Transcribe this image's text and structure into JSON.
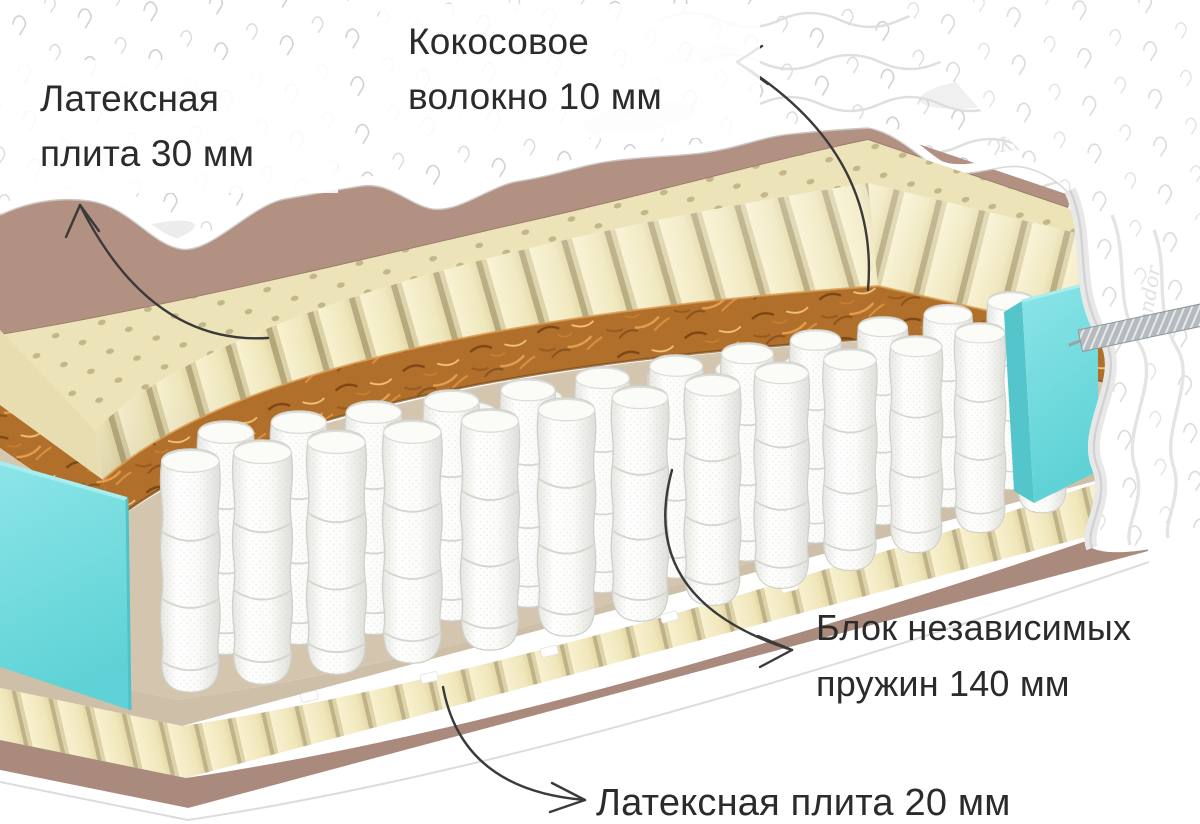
{
  "title": "Схема слоёв матраса в разрезе",
  "annotations": {
    "latex_top": {
      "line1": "Латексная",
      "line2": "плита 30 мм"
    },
    "coconut": {
      "line1": "Кокосовое",
      "line2": "волокно 10 мм"
    },
    "spring_block": {
      "line1": "Блок независимых",
      "line2": "пружин 140 мм"
    },
    "latex_bottom": {
      "line1": "Латексная плита 20 мм"
    }
  },
  "cover": {
    "watermark": "Kondor"
  },
  "layers": [
    {
      "name": "quilted-cover",
      "color": "#ffffff"
    },
    {
      "name": "felt-underlay",
      "color": "#b29183"
    },
    {
      "name": "latex-plate-30mm",
      "color": "#f2eac2"
    },
    {
      "name": "coconut-fiber-10mm",
      "color": "#b06f2a"
    },
    {
      "name": "spring-deck-felt",
      "color": "#d3c5ae"
    },
    {
      "name": "independent-spring-block-140mm",
      "color": "#f7f7f4"
    },
    {
      "name": "latex-plate-20mm",
      "color": "#f1e9c2"
    },
    {
      "name": "bottom-felt",
      "color": "#a98a7c"
    },
    {
      "name": "side-foam-border",
      "color": "#74dbde"
    },
    {
      "name": "zipper",
      "color": "#b6bcbf"
    },
    {
      "name": "arrow",
      "color": "#3a3a3a"
    }
  ]
}
